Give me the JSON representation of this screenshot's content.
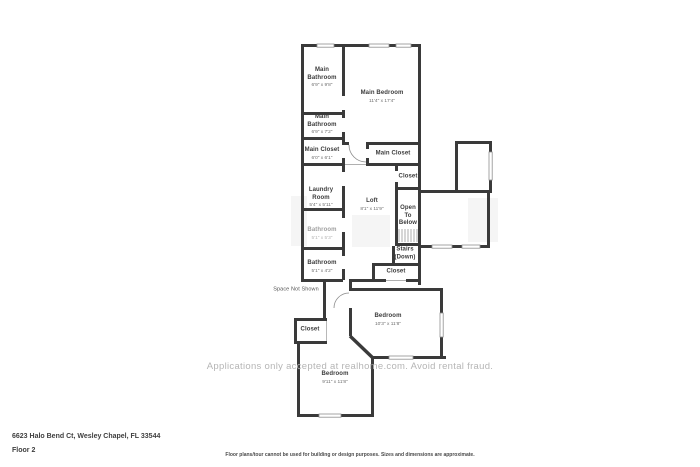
{
  "plan": {
    "rooms": {
      "main_bathroom_1": {
        "name": "Main Bathroom",
        "dims": "6'9\" x 9'8\""
      },
      "main_bedroom": {
        "name": "Main Bedroom",
        "dims": "11'4\" x 17'4\""
      },
      "main_bathroom_2": {
        "name": "Main Bathroom",
        "dims": "6'9\" x 7'2\""
      },
      "main_closet_left": {
        "name": "Main Closet",
        "dims": "6'0\" x 6'1\""
      },
      "main_closet_right": {
        "name": "Main Closet"
      },
      "closet_upper_right": {
        "name": "Closet"
      },
      "laundry": {
        "name": "Laundry Room",
        "dims": "5'4\" x 5'11\""
      },
      "loft": {
        "name": "Loft",
        "dims": "8'1\" x 11'9\""
      },
      "open_to_below": {
        "name": "Open To Below"
      },
      "bathroom_upper": {
        "name": "Bathroom",
        "dims": "5'1\" x 5'3\""
      },
      "stairs": {
        "name": "Stairs (Down)"
      },
      "bathroom_lower": {
        "name": "Bathroom",
        "dims": "5'1\" x 4'2\""
      },
      "closet_mid_right": {
        "name": "Closet"
      },
      "closet_bottom_left": {
        "name": "Closet"
      },
      "bedroom_right": {
        "name": "Bedroom",
        "dims": "10'3\" x 11'8\""
      },
      "bedroom_bottom": {
        "name": "Bedroom",
        "dims": "9'11\" x 11'8\""
      },
      "space_not_shown": {
        "name": "Space Not Shown"
      }
    },
    "watermark": "Applications only accepted at realhome.com. Avoid rental fraud."
  },
  "footer": {
    "address": "6623 Halo Bend Ct, Wesley Chapel, FL 33544",
    "floor": "Floor 2",
    "disclaimer": "Floor plans/tour cannot be used for building or design purposes. Sizes and dimensions are approximate."
  },
  "colors": {
    "wall": "#3a3a3a",
    "watermark": "#b5b5b5",
    "background": "#ffffff"
  }
}
